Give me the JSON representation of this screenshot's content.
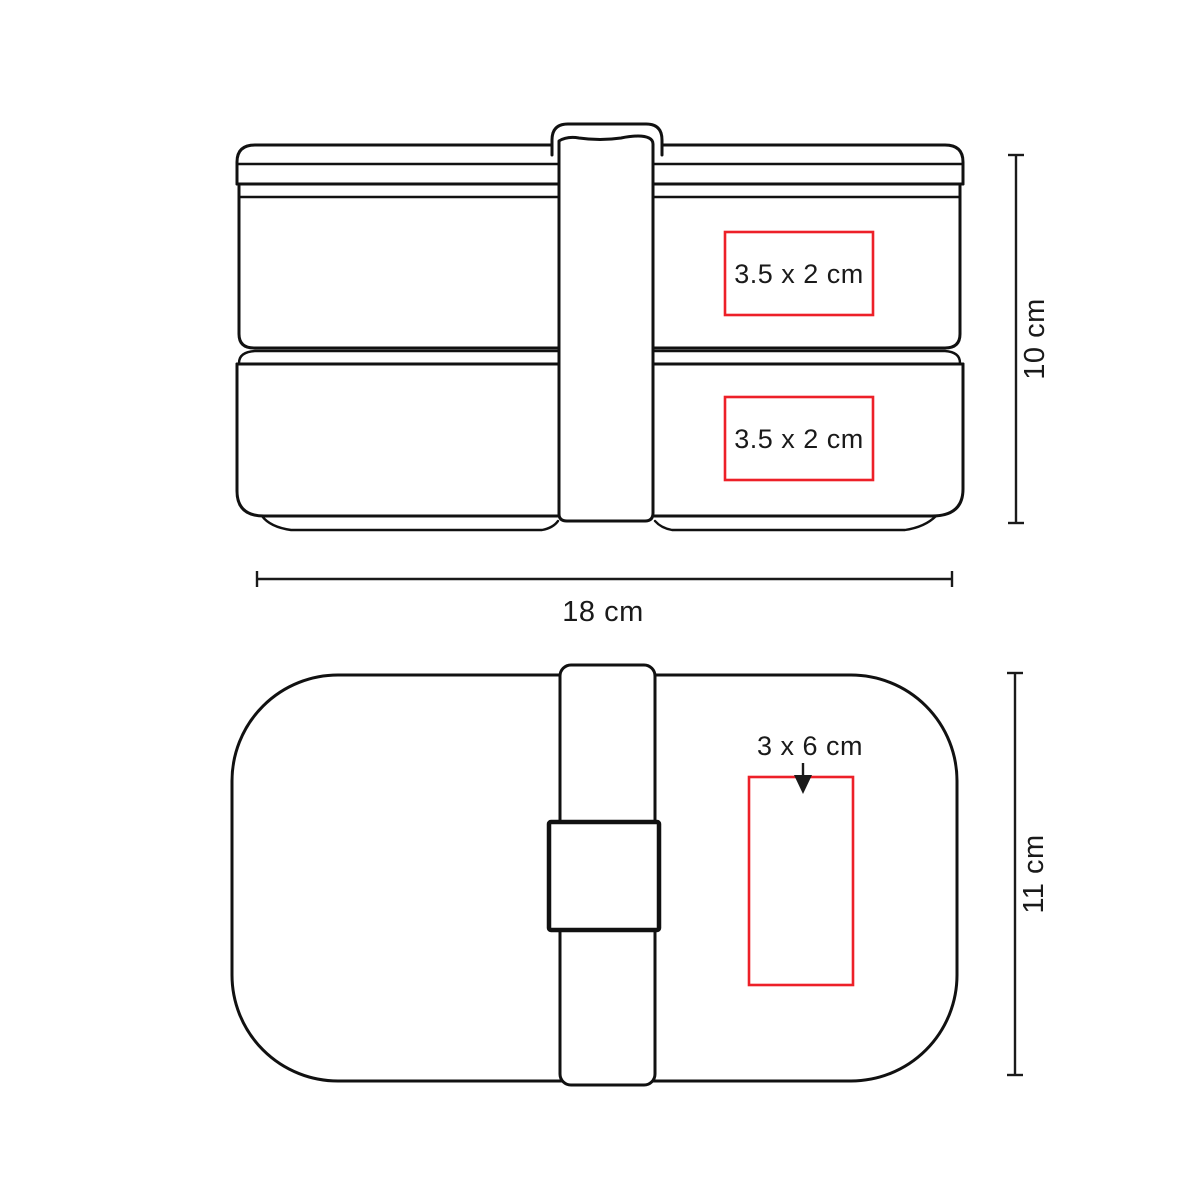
{
  "colors": {
    "print_area": "#ed2028",
    "line": "#111111",
    "text": "#1a1a1a"
  },
  "front_view": {
    "print_area_top_label": "3.5 x 2 cm",
    "print_area_bottom_label": "3.5 x 2 cm",
    "height_label": "10 cm",
    "width_label": "18 cm"
  },
  "top_view": {
    "print_area_label": "3 x 6 cm",
    "height_label": "11 cm"
  }
}
